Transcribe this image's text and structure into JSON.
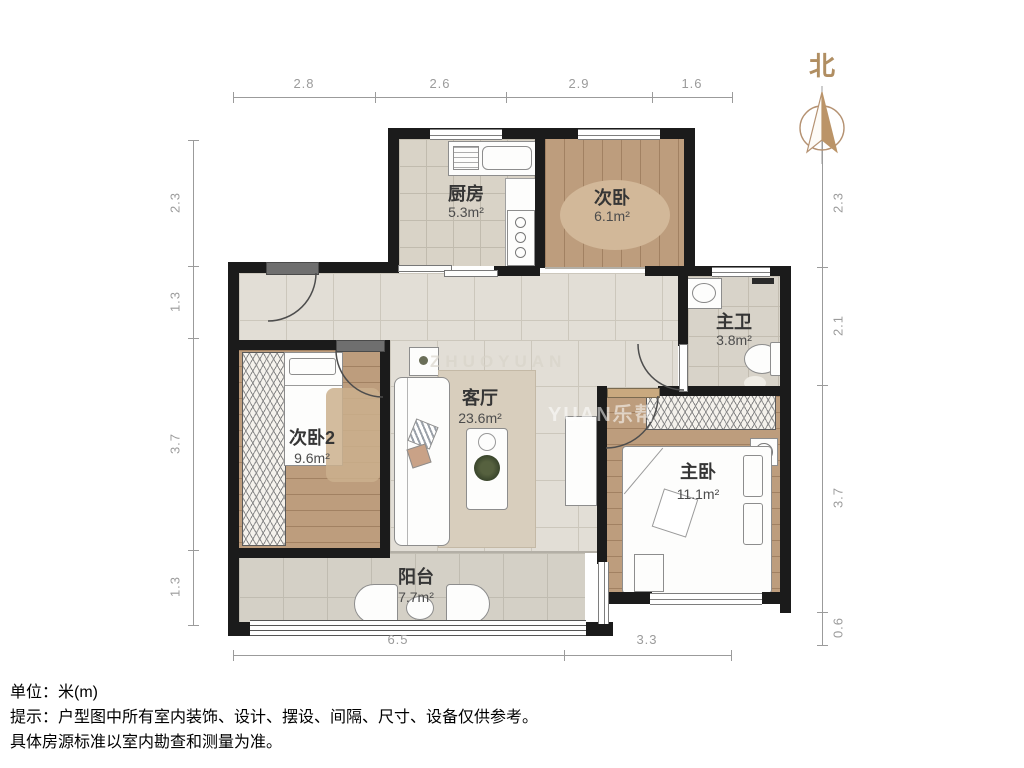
{
  "title": "户型图",
  "north": {
    "label": "北"
  },
  "rooms": [
    {
      "id": "kitchen",
      "label": "厨房",
      "area": "5.3m²"
    },
    {
      "id": "bedroom-second",
      "label": "次卧",
      "area": "6.1m²"
    },
    {
      "id": "master-bath",
      "label": "主卫",
      "area": "3.8m²"
    },
    {
      "id": "bedroom-second2",
      "label": "次卧2",
      "area": "9.6m²"
    },
    {
      "id": "living-room",
      "label": "客厅",
      "area": "23.6m²"
    },
    {
      "id": "master-bedroom",
      "label": "主卧",
      "area": "11.1m²"
    },
    {
      "id": "balcony",
      "label": "阳台",
      "area": "7.7m²"
    }
  ],
  "dimensions": {
    "unit": "米(m)",
    "top": [
      "2.8",
      "2.6",
      "2.9",
      "1.6"
    ],
    "left": [
      "2.3",
      "1.3",
      "3.7",
      "1.3"
    ],
    "right": [
      "2.3",
      "2.1",
      "3.7",
      "0.6"
    ],
    "bottom": [
      "6.5",
      "3.3"
    ]
  },
  "notes": {
    "line1": "单位：米(m)",
    "line2": "提示：户型图中所有室内装饰、设计、摆设、间隔、尺寸、设备仅供参考。",
    "line3": "具体房源标准以室内勘查和测量为准。"
  },
  "watermarks": [
    "ZHUOYUAN",
    "YUAN乐帮"
  ],
  "colors": {
    "wall": "#1b1b1b",
    "wood_floor": "#bd9d7d",
    "tile_floor": "#e2ded6",
    "north_accent": "#b08e62",
    "dimension_gray": "#9b9b9b"
  }
}
